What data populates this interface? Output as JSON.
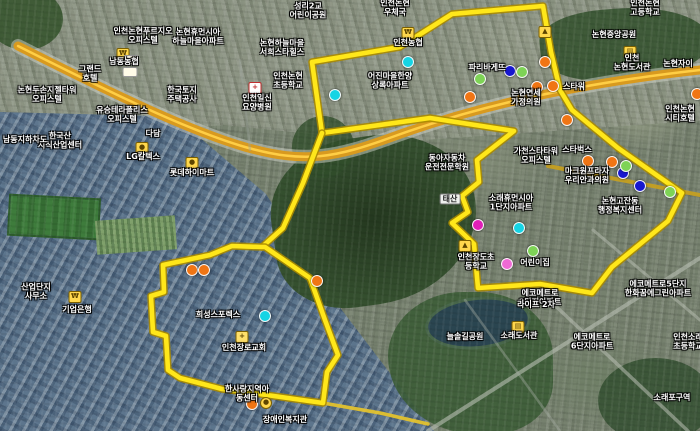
{
  "map": {
    "view": "satellite-aerial-3d",
    "colors": {
      "boundary": "#ffe71a",
      "boundary_casing": "#ab8b00",
      "highway": "#d89a1f",
      "highway_stripe": "#ffce45",
      "cyan": "#16d4e4",
      "orange": "#f07514",
      "blue": "#1717cf",
      "green": "#7ed356",
      "magenta": "#e01fb7",
      "pink": "#ef6ad4",
      "yellow": "#ffd021"
    },
    "labels": [
      {
        "x": 143,
        "y": 36,
        "lines": [
          "인천논현푸르지오",
          "오피스텔"
        ]
      },
      {
        "x": 198,
        "y": 37,
        "lines": [
          "논현휴먼시아",
          "하늘마을아파트"
        ]
      },
      {
        "x": 124,
        "y": 62,
        "lines": [
          "남동농협"
        ]
      },
      {
        "x": 90,
        "y": 74,
        "lines": [
          "그랜드",
          "호텔"
        ]
      },
      {
        "x": 47,
        "y": 95,
        "lines": [
          "논현두손지젤타워",
          "오피스텔"
        ]
      },
      {
        "x": 122,
        "y": 115,
        "lines": [
          "유승테라폴리스",
          "오피스텔"
        ]
      },
      {
        "x": 182,
        "y": 95,
        "lines": [
          "한국토지",
          "주택공사"
        ]
      },
      {
        "x": 153,
        "y": 134,
        "lines": [
          "다담"
        ]
      },
      {
        "x": 60,
        "y": 141,
        "lines": [
          "한국산",
          "지식산업센터"
        ]
      },
      {
        "x": 25,
        "y": 140,
        "lines": [
          "남동지하차도"
        ]
      },
      {
        "x": 143,
        "y": 157,
        "lines": [
          "LG칼텍스"
        ]
      },
      {
        "x": 192,
        "y": 173,
        "lines": [
          "롯데하이마트"
        ]
      },
      {
        "x": 36,
        "y": 292,
        "lines": [
          "산업단지",
          "사무소"
        ]
      },
      {
        "x": 77,
        "y": 310,
        "lines": [
          "기업은행"
        ]
      },
      {
        "x": 308,
        "y": 11,
        "lines": [
          "성리2교",
          "어린이공원"
        ]
      },
      {
        "x": 395,
        "y": 8,
        "lines": [
          "인천논현",
          "우체국"
        ]
      },
      {
        "x": 408,
        "y": 43,
        "lines": [
          "인천농협"
        ]
      },
      {
        "x": 282,
        "y": 48,
        "lines": [
          "논현하늘마을",
          "서희스타힐스"
        ]
      },
      {
        "x": 288,
        "y": 81,
        "lines": [
          "인천논현",
          "초등학교"
        ]
      },
      {
        "x": 257,
        "y": 103,
        "lines": [
          "인천일신",
          "요양병원"
        ]
      },
      {
        "x": 390,
        "y": 81,
        "lines": [
          "어진마을한양",
          "상록아파트"
        ]
      },
      {
        "x": 447,
        "y": 163,
        "lines": [
          "동아자동차",
          "운전전문학원"
        ]
      },
      {
        "x": 450,
        "y": 199,
        "lines": [
          "태산"
        ],
        "box": true
      },
      {
        "x": 511,
        "y": 203,
        "lines": [
          "소래휴먼시아",
          "1단지아파트"
        ]
      },
      {
        "x": 476,
        "y": 262,
        "lines": [
          "인천장도초",
          "등학교"
        ]
      },
      {
        "x": 535,
        "y": 263,
        "lines": [
          "어린이집"
        ]
      },
      {
        "x": 540,
        "y": 298,
        "lines": [
          "에코메트로",
          "2단지아파트"
        ]
      },
      {
        "x": 536,
        "y": 156,
        "lines": [
          "가천스타타워",
          "오피스텔"
        ]
      },
      {
        "x": 577,
        "y": 150,
        "lines": [
          "스타벅스"
        ]
      },
      {
        "x": 587,
        "y": 176,
        "lines": [
          "마크원프라자",
          "우리안과의원"
        ]
      },
      {
        "x": 620,
        "y": 206,
        "lines": [
          "논현고잔동",
          "행정복지센터"
        ]
      },
      {
        "x": 487,
        "y": 68,
        "lines": [
          "파리바게뜨"
        ]
      },
      {
        "x": 526,
        "y": 98,
        "lines": [
          "논현연세",
          "가정의원"
        ]
      },
      {
        "x": 574,
        "y": 87,
        "lines": [
          "스타워"
        ]
      },
      {
        "x": 614,
        "y": 35,
        "lines": [
          "논현중앙공원"
        ]
      },
      {
        "x": 632,
        "y": 63,
        "lines": [
          "인천",
          "논현도서관"
        ]
      },
      {
        "x": 645,
        "y": 8,
        "lines": [
          "인천논현",
          "고등학교"
        ]
      },
      {
        "x": 678,
        "y": 64,
        "lines": [
          "논현자이"
        ]
      },
      {
        "x": 680,
        "y": 114,
        "lines": [
          "인천논현",
          "시티호텔"
        ]
      },
      {
        "x": 658,
        "y": 289,
        "lines": [
          "에코메트로5단지",
          "한화꿈에그린아파트"
        ]
      },
      {
        "x": 592,
        "y": 342,
        "lines": [
          "에코메트로",
          "6단지아파트"
        ]
      },
      {
        "x": 688,
        "y": 342,
        "lines": [
          "인천소래",
          "초등학교"
        ]
      },
      {
        "x": 465,
        "y": 337,
        "lines": [
          "늘솔길공원"
        ]
      },
      {
        "x": 519,
        "y": 336,
        "lines": [
          "소래도서관"
        ]
      },
      {
        "x": 536,
        "y": 305,
        "lines": [
          "라이프 2차"
        ]
      },
      {
        "x": 672,
        "y": 398,
        "lines": [
          "소래포구역"
        ]
      },
      {
        "x": 218,
        "y": 315,
        "lines": [
          "희성스포렉스"
        ]
      },
      {
        "x": 244,
        "y": 348,
        "lines": [
          "인천장로교회"
        ]
      },
      {
        "x": 247,
        "y": 394,
        "lines": [
          "한사랑지역아",
          "동센터"
        ]
      },
      {
        "x": 285,
        "y": 420,
        "lines": [
          "장애인복지관"
        ]
      }
    ],
    "markers": [
      {
        "x": 408,
        "y": 62,
        "color": "cyan"
      },
      {
        "x": 335,
        "y": 95,
        "color": "cyan"
      },
      {
        "x": 519,
        "y": 228,
        "color": "cyan"
      },
      {
        "x": 265,
        "y": 316,
        "color": "cyan"
      },
      {
        "x": 545,
        "y": 62,
        "color": "orange"
      },
      {
        "x": 470,
        "y": 97,
        "color": "orange"
      },
      {
        "x": 537,
        "y": 87,
        "color": "orange"
      },
      {
        "x": 553,
        "y": 86,
        "color": "orange"
      },
      {
        "x": 567,
        "y": 120,
        "color": "orange"
      },
      {
        "x": 588,
        "y": 161,
        "color": "orange"
      },
      {
        "x": 612,
        "y": 162,
        "color": "orange"
      },
      {
        "x": 697,
        "y": 94,
        "color": "orange"
      },
      {
        "x": 192,
        "y": 270,
        "color": "orange"
      },
      {
        "x": 204,
        "y": 270,
        "color": "orange"
      },
      {
        "x": 317,
        "y": 281,
        "color": "orange"
      },
      {
        "x": 252,
        "y": 404,
        "color": "orange"
      },
      {
        "x": 510,
        "y": 71,
        "color": "blue"
      },
      {
        "x": 623,
        "y": 173,
        "color": "blue"
      },
      {
        "x": 640,
        "y": 186,
        "color": "blue"
      },
      {
        "x": 480,
        "y": 79,
        "color": "green"
      },
      {
        "x": 522,
        "y": 72,
        "color": "green"
      },
      {
        "x": 626,
        "y": 166,
        "color": "green"
      },
      {
        "x": 670,
        "y": 192,
        "color": "green"
      },
      {
        "x": 533,
        "y": 251,
        "color": "green"
      },
      {
        "x": 478,
        "y": 225,
        "color": "magenta"
      },
      {
        "x": 507,
        "y": 264,
        "color": "pink"
      }
    ],
    "icons": [
      {
        "x": 123,
        "y": 54,
        "type": "bank",
        "glyph": "₩"
      },
      {
        "x": 408,
        "y": 33,
        "type": "bank",
        "glyph": "₩"
      },
      {
        "x": 75,
        "y": 297,
        "type": "bank",
        "glyph": "₩"
      },
      {
        "x": 630,
        "y": 52,
        "type": "library",
        "glyph": "▤"
      },
      {
        "x": 518,
        "y": 327,
        "type": "library",
        "glyph": "▤"
      },
      {
        "x": 142,
        "y": 148,
        "type": "fuel",
        "glyph": "●"
      },
      {
        "x": 192,
        "y": 163,
        "type": "store",
        "glyph": "●"
      },
      {
        "x": 242,
        "y": 337,
        "type": "church",
        "glyph": "+"
      },
      {
        "x": 465,
        "y": 246,
        "type": "school",
        "glyph": "▲"
      },
      {
        "x": 545,
        "y": 32,
        "type": "school",
        "glyph": "▲"
      },
      {
        "x": 255,
        "y": 88,
        "type": "hospital",
        "glyph": "+"
      },
      {
        "x": 266,
        "y": 403,
        "type": "coin",
        "glyph": "●"
      },
      {
        "x": 131,
        "y": 60,
        "type": "route-shield",
        "glyph": ""
      },
      {
        "x": 130,
        "y": 72,
        "type": "route-shield",
        "glyph": ""
      }
    ],
    "overlay": {
      "boundary_paths": [
        "M312,62 L400,47 L452,14 L543,6 L551,52 L560,90 L572,110 L618,148 L682,193 L668,221 L612,267 L592,293 L540,284 L478,288 L474,244 L452,223 L468,212 L462,196 L479,182 L477,160 L514,131 L430,118 L322,133 Z",
        "M322,133 L303,183 L283,228 L262,247",
        "M262,247 L232,246 L210,255 L163,265 L164,292 L151,296 L153,332 L166,336 L168,370 L180,378 L222,389 L246,392 L323,403 L327,372 L338,355 L325,320 L310,278 L265,247 Z"
      ],
      "roads": [
        {
          "d": "M18,46 C90,82 180,128 245,147 C305,164 335,158 395,136 C470,109 565,85 700,70",
          "color": "#cfd3c9",
          "width": 14,
          "opacity": 0.5
        },
        {
          "d": "M18,46 C90,82 180,128 245,147 C305,164 335,158 395,136 C470,109 565,85 700,70",
          "color": "#d89a1f",
          "width": 9,
          "opacity": 1
        },
        {
          "d": "M18,46 C90,82 180,128 245,147 C305,164 335,158 395,136 C470,109 565,85 700,70",
          "color": "#ffce45",
          "width": 2.5,
          "opacity": 1
        },
        {
          "d": "M548,166 L700,195",
          "color": "#c9a11d",
          "width": 4,
          "opacity": 0.9
        },
        {
          "d": "M323,403 L380,413 L428,424",
          "color": "#e3c22e",
          "width": 3.5,
          "opacity": 0.95
        },
        {
          "d": "M428,431 L700,258",
          "color": "#b9c0b4",
          "width": 4,
          "opacity": 0.6
        },
        {
          "d": "M545,296 L688,431",
          "color": "#b9c0b4",
          "width": 3.5,
          "opacity": 0.55
        },
        {
          "d": "M593,230 L700,320",
          "color": "#b9c0b4",
          "width": 3,
          "opacity": 0.5
        },
        {
          "d": "M465,300 L560,431",
          "color": "#a8b0a6",
          "width": 2.5,
          "opacity": 0.4
        },
        {
          "d": "M240,60 L250,150",
          "color": "#9aa39a",
          "width": 2.5,
          "opacity": 0.4
        }
      ]
    }
  }
}
